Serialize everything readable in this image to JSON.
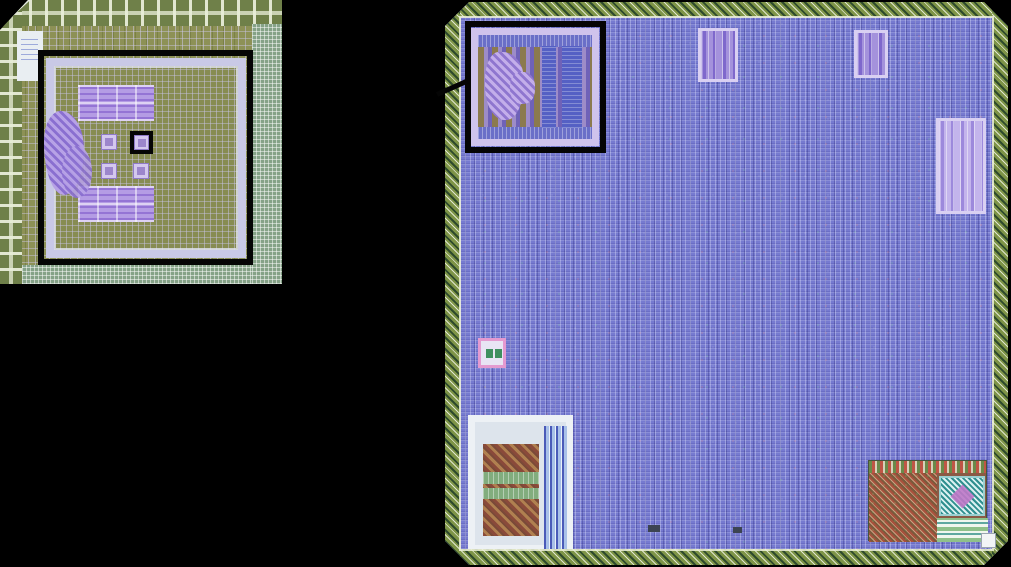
{
  "figure": {
    "kind": "chip die micrograph figure with zoom callout",
    "background_color": "#000000",
    "panels": {
      "overview": {
        "name": "test-chip overview micrograph",
        "annotations": [
          "core outline box",
          "macro location box"
        ],
        "features": [
          "pad ring",
          "core power ring",
          "upper macro array",
          "lower macro array",
          "analog blob",
          "four small macros",
          "logo label"
        ]
      },
      "zoom": {
        "name": "magnified die micrograph",
        "annotations": [
          "zoomed macro box"
        ],
        "features": [
          "pad ring with chamfered corners",
          "standard-cell fill",
          "zoomed macro block",
          "top-middle macro",
          "top-right macro",
          "right-side macro",
          "pink-bordered macro",
          "white-framed analog block",
          "memory block with teal crosshatch"
        ]
      }
    },
    "annotation_color": "#000000",
    "colors": {
      "overview_base": "#8d9156",
      "overview_pads": "#6f8049",
      "core_ring": "#c9c9e6",
      "macro_purple": "#b49ce4",
      "zoom_fill": "#767ad0",
      "pad_ring_hatch": "#7e9447",
      "callout_ring": "#cfc3ec",
      "callout_blue_bar": "#5560c4",
      "memory_red": "#a8503c",
      "teal_hatch": "#2f8f8f",
      "frame_white": "#edf1f5",
      "pink_border": "#e49ad0"
    }
  }
}
